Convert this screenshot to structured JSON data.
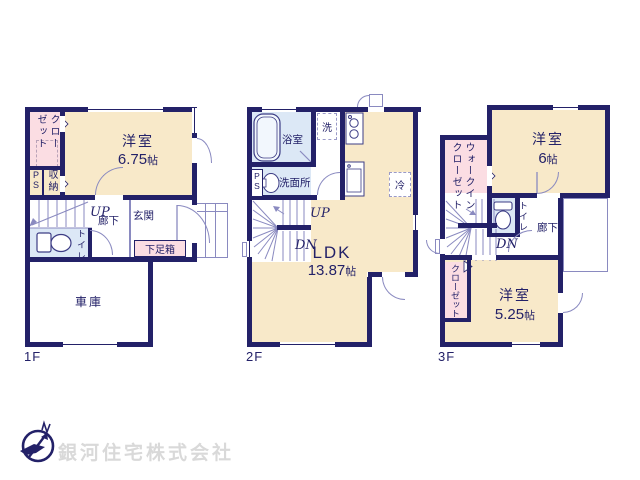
{
  "palette": {
    "wall_navy": "#232168",
    "room_cream": "#f8e9c9",
    "closet_pink": "#fbdde3",
    "wet_area_blue": "#dce8f6",
    "thin_line": "#8a8ac0",
    "company_gray": "#d9d9d9"
  },
  "floors": {
    "f1": {
      "label": "1F",
      "closet": "クローゼット",
      "ps": "PS",
      "storage": "収納",
      "room": {
        "name": "洋室",
        "size_value": "6.75",
        "size_unit": "帖"
      },
      "up": "UP",
      "hallway": "廊下",
      "entrance": "玄関",
      "shoe_box": "下足箱",
      "toilet": "トイレ",
      "garage": "車庫"
    },
    "f2": {
      "label": "2F",
      "bathroom": "浴室",
      "washer": "洗",
      "washroom": "洗面所",
      "ps": "PS",
      "fridge": "冷",
      "up": "UP",
      "dn": "DN",
      "ldk": {
        "name": "LDK",
        "size_value": "13.87",
        "size_unit": "帖"
      }
    },
    "f3": {
      "label": "3F",
      "walk_in_closet": "ウォークインクローゼット",
      "room_a": {
        "name": "洋室",
        "size_value": "6",
        "size_unit": "帖"
      },
      "toilet": "トイレ",
      "hallway": "廊下",
      "dn": "DN",
      "closet": "クローゼット",
      "room_b": {
        "name": "洋室",
        "size_value": "5.25",
        "size_unit": "帖"
      }
    }
  },
  "footer": {
    "company_name": "銀河住宅株式会社",
    "logo": "compass-north-icon"
  }
}
